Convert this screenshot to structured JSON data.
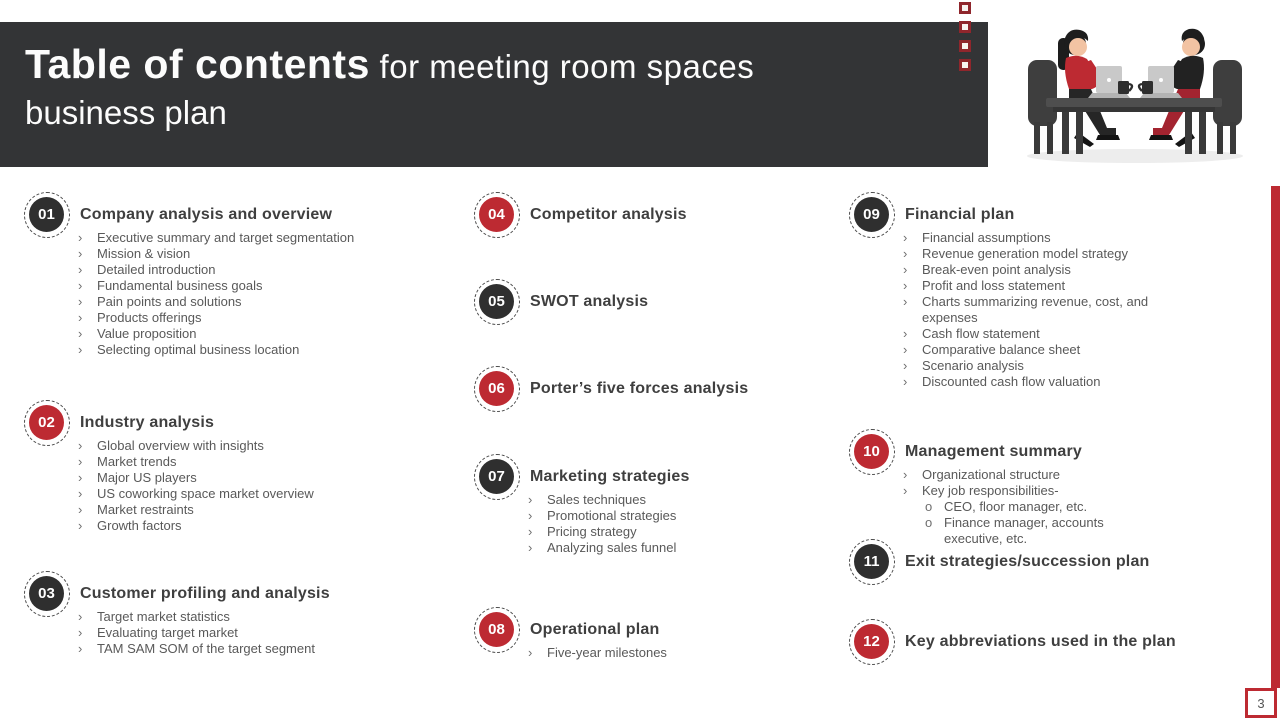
{
  "header": {
    "title_emphasis": "Table of contents",
    "title_suffix": " for meeting room spaces",
    "title_line2": "business plan"
  },
  "page_number": "3",
  "colors": {
    "accent_red": "#bd2a32",
    "badge_dark": "#2f2f2f",
    "header_bg": "#333436"
  },
  "illustration": "two-people-at-meeting-table-with-laptops-and-coffee",
  "columns": [
    {
      "sections": [
        {
          "number": "01",
          "badge": "dark",
          "title": "Company analysis and overview",
          "bullets": [
            {
              "t": "Executive summary and target segmentation",
              "l": 1
            },
            {
              "t": "Mission & vision",
              "l": 1
            },
            {
              "t": "Detailed introduction",
              "l": 1
            },
            {
              "t": "Fundamental business goals",
              "l": 1
            },
            {
              "t": "Pain points and solutions",
              "l": 1
            },
            {
              "t": "Products offerings",
              "l": 1
            },
            {
              "t": "Value proposition",
              "l": 1
            },
            {
              "t": "Selecting optimal business location",
              "l": 1
            }
          ]
        },
        {
          "number": "02",
          "badge": "red",
          "title": "Industry analysis",
          "bullets": [
            {
              "t": "Global overview with insights",
              "l": 1
            },
            {
              "t": "Market trends",
              "l": 1
            },
            {
              "t": "Major US players",
              "l": 1
            },
            {
              "t": "US coworking space market overview",
              "l": 1
            },
            {
              "t": "Market restraints",
              "l": 1
            },
            {
              "t": "Growth factors",
              "l": 1
            }
          ]
        },
        {
          "number": "03",
          "badge": "dark",
          "title": "Customer profiling and analysis",
          "bullets": [
            {
              "t": "Target market statistics",
              "l": 1
            },
            {
              "t": "Evaluating target market",
              "l": 1
            },
            {
              "t": "TAM SAM SOM of the target segment",
              "l": 1
            }
          ]
        }
      ]
    },
    {
      "sections": [
        {
          "number": "04",
          "badge": "red",
          "title": "Competitor analysis",
          "bullets": []
        },
        {
          "number": "05",
          "badge": "dark",
          "title": "SWOT analysis",
          "bullets": []
        },
        {
          "number": "06",
          "badge": "red",
          "title": "Porter’s five forces analysis",
          "bullets": []
        },
        {
          "number": "07",
          "badge": "dark",
          "title": "Marketing strategies",
          "bullets": [
            {
              "t": "Sales techniques",
              "l": 1
            },
            {
              "t": "Promotional strategies",
              "l": 1
            },
            {
              "t": "Pricing strategy",
              "l": 1
            },
            {
              "t": "Analyzing sales funnel",
              "l": 1
            }
          ]
        },
        {
          "number": "08",
          "badge": "red",
          "title": "Operational plan",
          "bullets": [
            {
              "t": "Five-year milestones",
              "l": 1
            }
          ]
        }
      ]
    },
    {
      "sections": [
        {
          "number": "09",
          "badge": "dark",
          "title": "Financial plan",
          "bullets": [
            {
              "t": "Financial assumptions",
              "l": 1
            },
            {
              "t": "Revenue generation model strategy",
              "l": 1
            },
            {
              "t": "Break-even point analysis",
              "l": 1
            },
            {
              "t": "Profit and loss statement",
              "l": 1
            },
            {
              "t": "Charts summarizing revenue, cost, and expenses",
              "l": 1
            },
            {
              "t": "Cash flow statement",
              "l": 1
            },
            {
              "t": "Comparative balance sheet",
              "l": 1
            },
            {
              "t": "Scenario analysis",
              "l": 1
            },
            {
              "t": "Discounted cash flow valuation",
              "l": 1
            }
          ]
        },
        {
          "number": "10",
          "badge": "red",
          "title": "Management summary",
          "bullets": [
            {
              "t": "Organizational structure",
              "l": 1
            },
            {
              "t": "Key job responsibilities-",
              "l": 1
            },
            {
              "t": "CEO, floor manager, etc.",
              "l": 2
            },
            {
              "t": "Finance manager, accounts executive, etc.",
              "l": 2
            }
          ]
        },
        {
          "number": "11",
          "badge": "dark",
          "title": "Exit strategies/succession plan",
          "bullets": []
        },
        {
          "number": "12",
          "badge": "red",
          "title": "Key abbreviations used in the plan",
          "bullets": []
        }
      ]
    }
  ]
}
